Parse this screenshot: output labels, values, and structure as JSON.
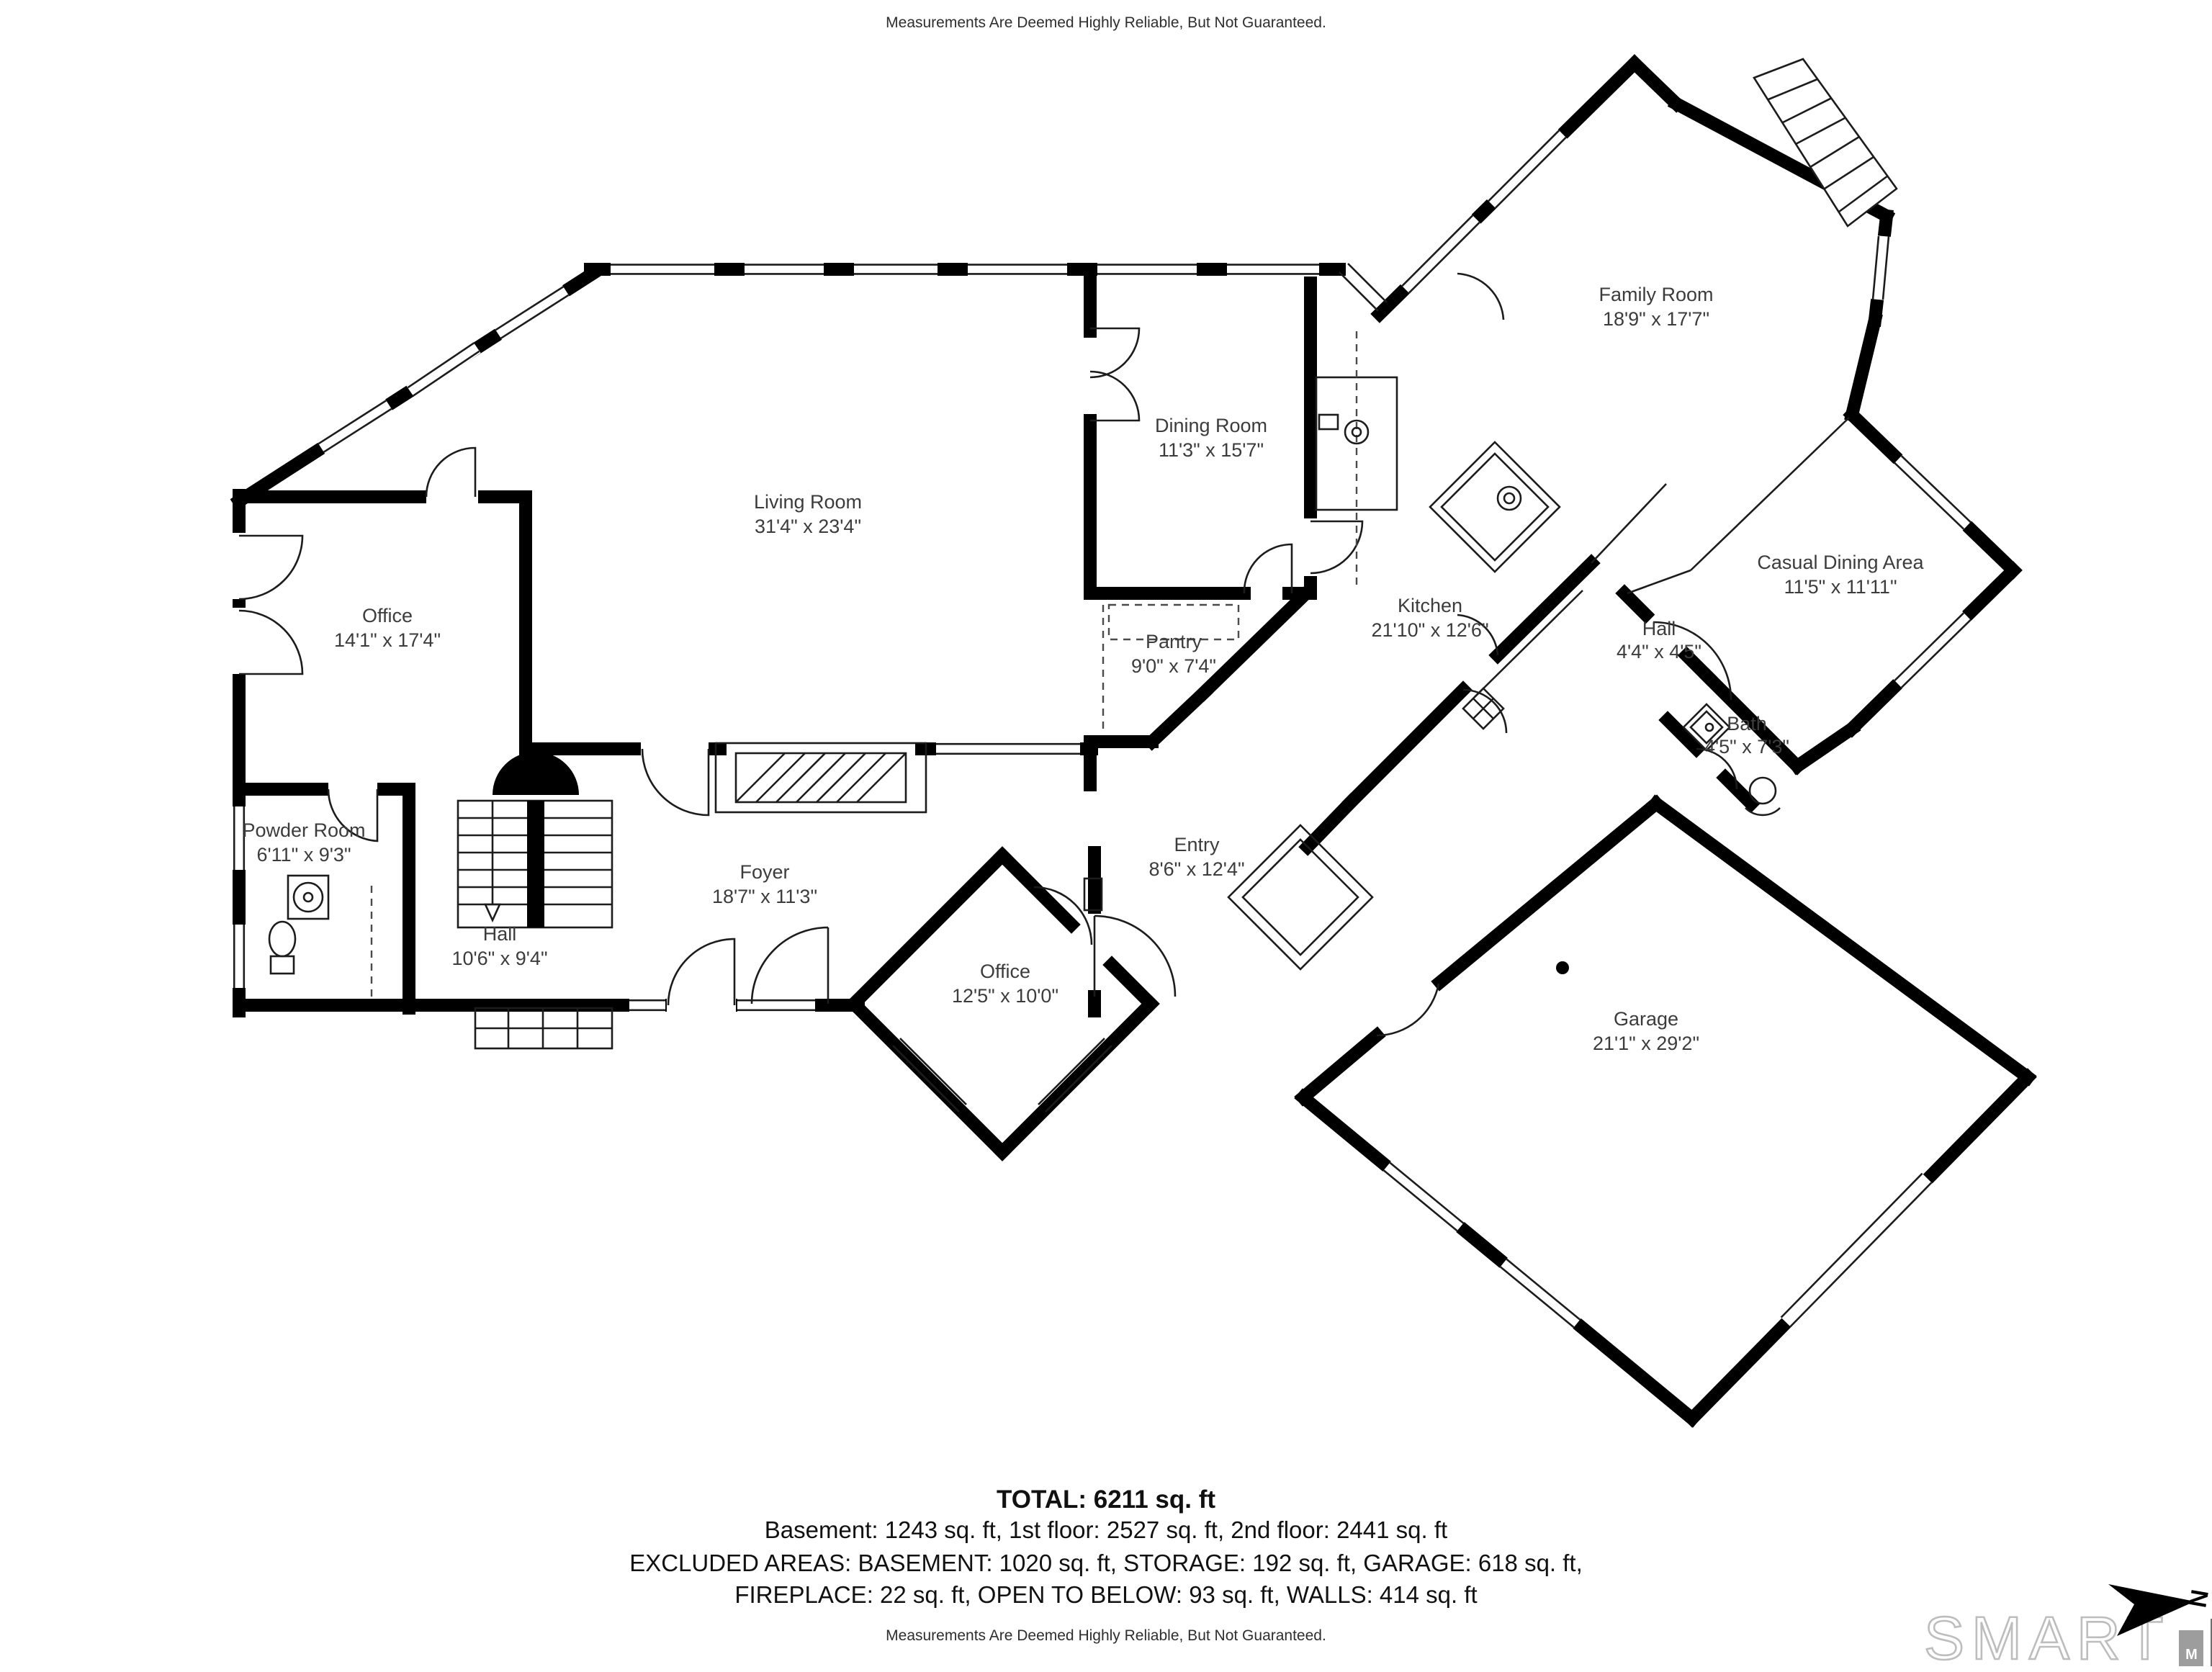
{
  "disclaimer_top": "Measurements Are Deemed Highly Reliable, But Not Guaranteed.",
  "disclaimer_bottom": "Measurements Are Deemed Highly Reliable, But Not Guaranteed.",
  "rooms": [
    {
      "name": "Family Room",
      "dims": "18'9\" x 17'7\""
    },
    {
      "name": "Dining Room",
      "dims": "11'3\" x 15'7\""
    },
    {
      "name": "Living Room",
      "dims": "31'4\" x 23'4\""
    },
    {
      "name": "Office",
      "dims": "14'1\" x 17'4\""
    },
    {
      "name": "Kitchen",
      "dims": "21'10\" x 12'6\""
    },
    {
      "name": "Pantry",
      "dims": "9'0\" x 7'4\""
    },
    {
      "name": "Casual Dining Area",
      "dims": "11'5\" x 11'11\""
    },
    {
      "name": "Hall",
      "dims": "4'4\" x 4'5\""
    },
    {
      "name": "Bath",
      "dims": "4'5\" x 7'3\""
    },
    {
      "name": "Powder Room",
      "dims": "6'11\" x 9'3\""
    },
    {
      "name": "Foyer",
      "dims": "18'7\" x 11'3\""
    },
    {
      "name": "Hall",
      "dims": "10'6\" x 9'4\""
    },
    {
      "name": "Office",
      "dims": "12'5\" x 10'0\""
    },
    {
      "name": "Entry",
      "dims": "8'6\" x 12'4\""
    },
    {
      "name": "Garage",
      "dims": "21'1\" x 29'2\""
    }
  ],
  "summary": {
    "total": "TOTAL: 6211 sq. ft",
    "floors": "Basement: 1243 sq. ft, 1st floor: 2527 sq. ft, 2nd floor: 2441 sq. ft",
    "excluded1": "EXCLUDED AREAS: BASEMENT: 1020 sq. ft, STORAGE: 192 sq. ft, GARAGE: 618 sq. ft,",
    "excluded2": "FIREPLACE: 22 sq. ft, OPEN TO BELOW: 93 sq. ft, WALLS: 414 sq. ft"
  },
  "logo": {
    "brand": "SMART",
    "letters": [
      "M",
      "L",
      "S"
    ]
  },
  "north_label": "N",
  "colors": {
    "wall": "#000000",
    "label_text": "#3c3c3c",
    "bar_m": "#9d9d9d",
    "bar_l": "#6e6e6e",
    "bar_s": "#3f3f3f"
  }
}
